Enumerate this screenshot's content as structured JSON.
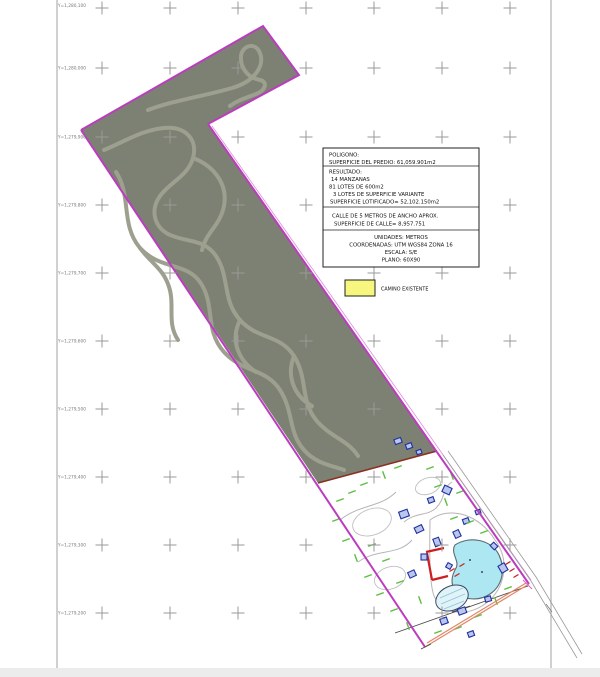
{
  "info_boxes": {
    "poligono": {
      "lines": [
        "POLIGONO:",
        "SUPERFICIE DEL PREDIO: 61,059.901m2"
      ]
    },
    "resultado": {
      "lines": [
        "RESULTADO:",
        "14 MANZANAS",
        "81 LOTES DE 600m2",
        "3 LOTES DE SUPERFICIE VARIANTE",
        "SUPERFICIE LOTIFICADO= 52,102.150m2"
      ]
    },
    "calle": {
      "lines": [
        "CALLE DE 5 METROS DE ANCHO APROX.",
        "SUPERFICIE DE CALLE= 8,957.751"
      ]
    },
    "unidades": {
      "lines": [
        "UNIDADES: METROS",
        "COORDENADAS: UTM WGS84 ZONA 16",
        "ESCALA: S/E",
        "PLANO: 60X90"
      ]
    }
  },
  "legend": {
    "camino_label": "CAMINO EXISTENTE"
  },
  "grid": {
    "row_labels": [
      "Y=1,280,100",
      "Y=1,280,000",
      "Y=1,279,900",
      "Y=1,279,800",
      "Y=1,279,700",
      "Y=1,279,600",
      "Y=1,279,500",
      "Y=1,279,400",
      "Y=1,279,300",
      "Y=1,279,200"
    ]
  },
  "colors": {
    "predio": "#7d8173",
    "troad": "#9da08e",
    "magenta": "#bb3cbe",
    "rededge": "#8b3020",
    "salmon": "#e08868",
    "pond": "#ace7f2",
    "building": "#cc2020",
    "structure": "#2030a0",
    "veg": "#5abf3f",
    "camino": "#f7f77f",
    "grid": "#9a9a9a",
    "frame": "#b0b0b0"
  }
}
